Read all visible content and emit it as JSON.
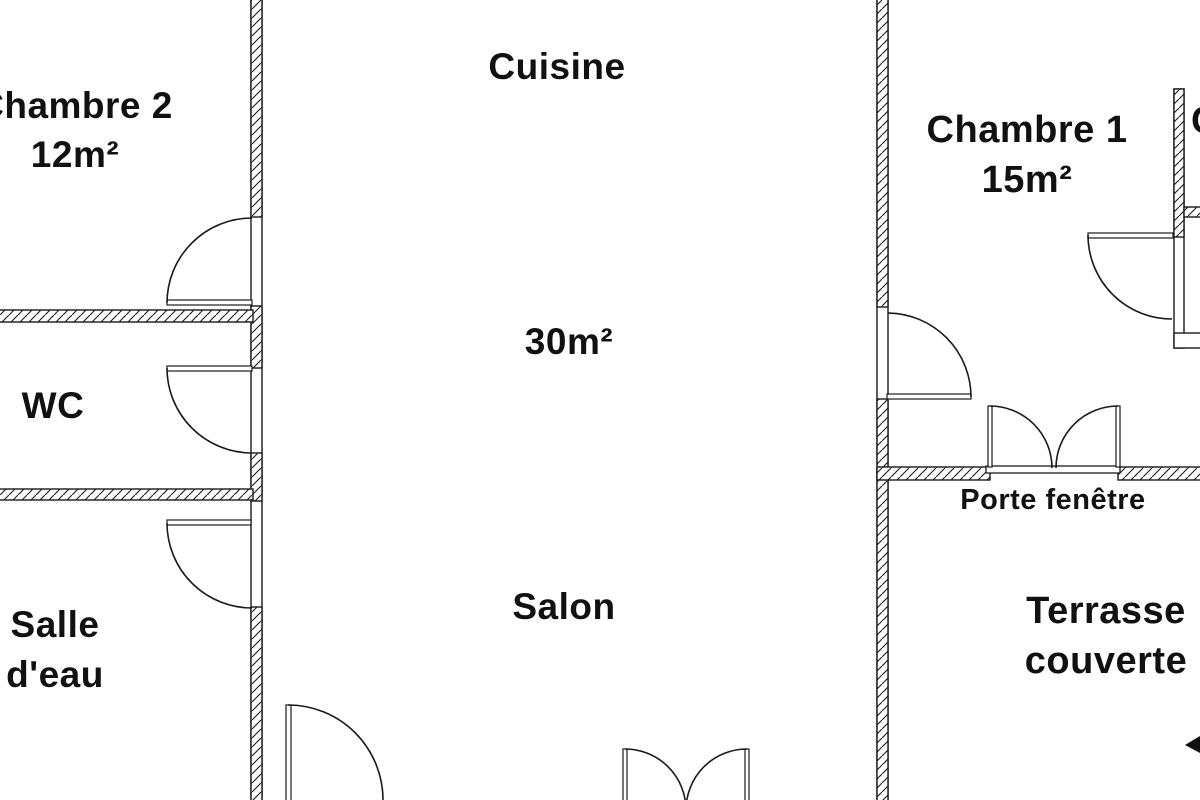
{
  "plan": {
    "type": "floor-plan",
    "colors": {
      "background": "#ffffff",
      "wall_line": "#1a1a1a",
      "text": "#111111"
    },
    "labels": {
      "chambre2_name": "Chambre 2",
      "chambre2_area": "12m²",
      "cuisine": "Cuisine",
      "living_area": "30m²",
      "wc": "WC",
      "salle_eau": "Salle d'eau",
      "salon": "Salon",
      "chambre1_name": "Chambre 1",
      "chambre1_area": "15m²",
      "porte_fenetre": "Porte fenêtre",
      "terrasse": "Terrasse couverte",
      "adjacent_room_partial": "C"
    }
  }
}
